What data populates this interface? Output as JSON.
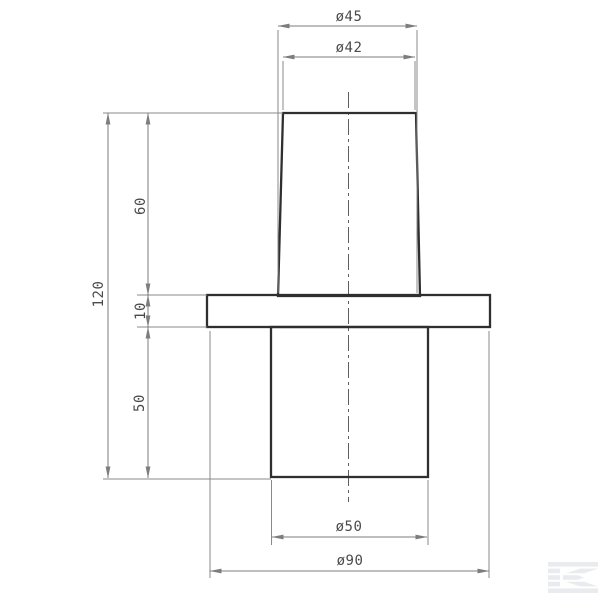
{
  "page": {
    "kind": "engineering technical drawing, front section view of a flanged tapered bushing",
    "background": "#ffffff"
  },
  "drawing": {
    "dimensions": {
      "cone_base_diameter": "ø45",
      "cone_top_diameter": "ø42",
      "cone_height": "60",
      "overall_height": "120",
      "flange_thickness": "10",
      "spigot_height": "50",
      "spigot_diameter": "ø50",
      "flange_diameter": "ø90"
    },
    "colors": {
      "part_outline": "#2f2f2f",
      "dimension_lines": "#7d7d7d",
      "dimension_text": "#4a4a4a",
      "watermark": "#e9ebee"
    }
  },
  "watermark": {
    "icon": "kramp-k-logo"
  }
}
